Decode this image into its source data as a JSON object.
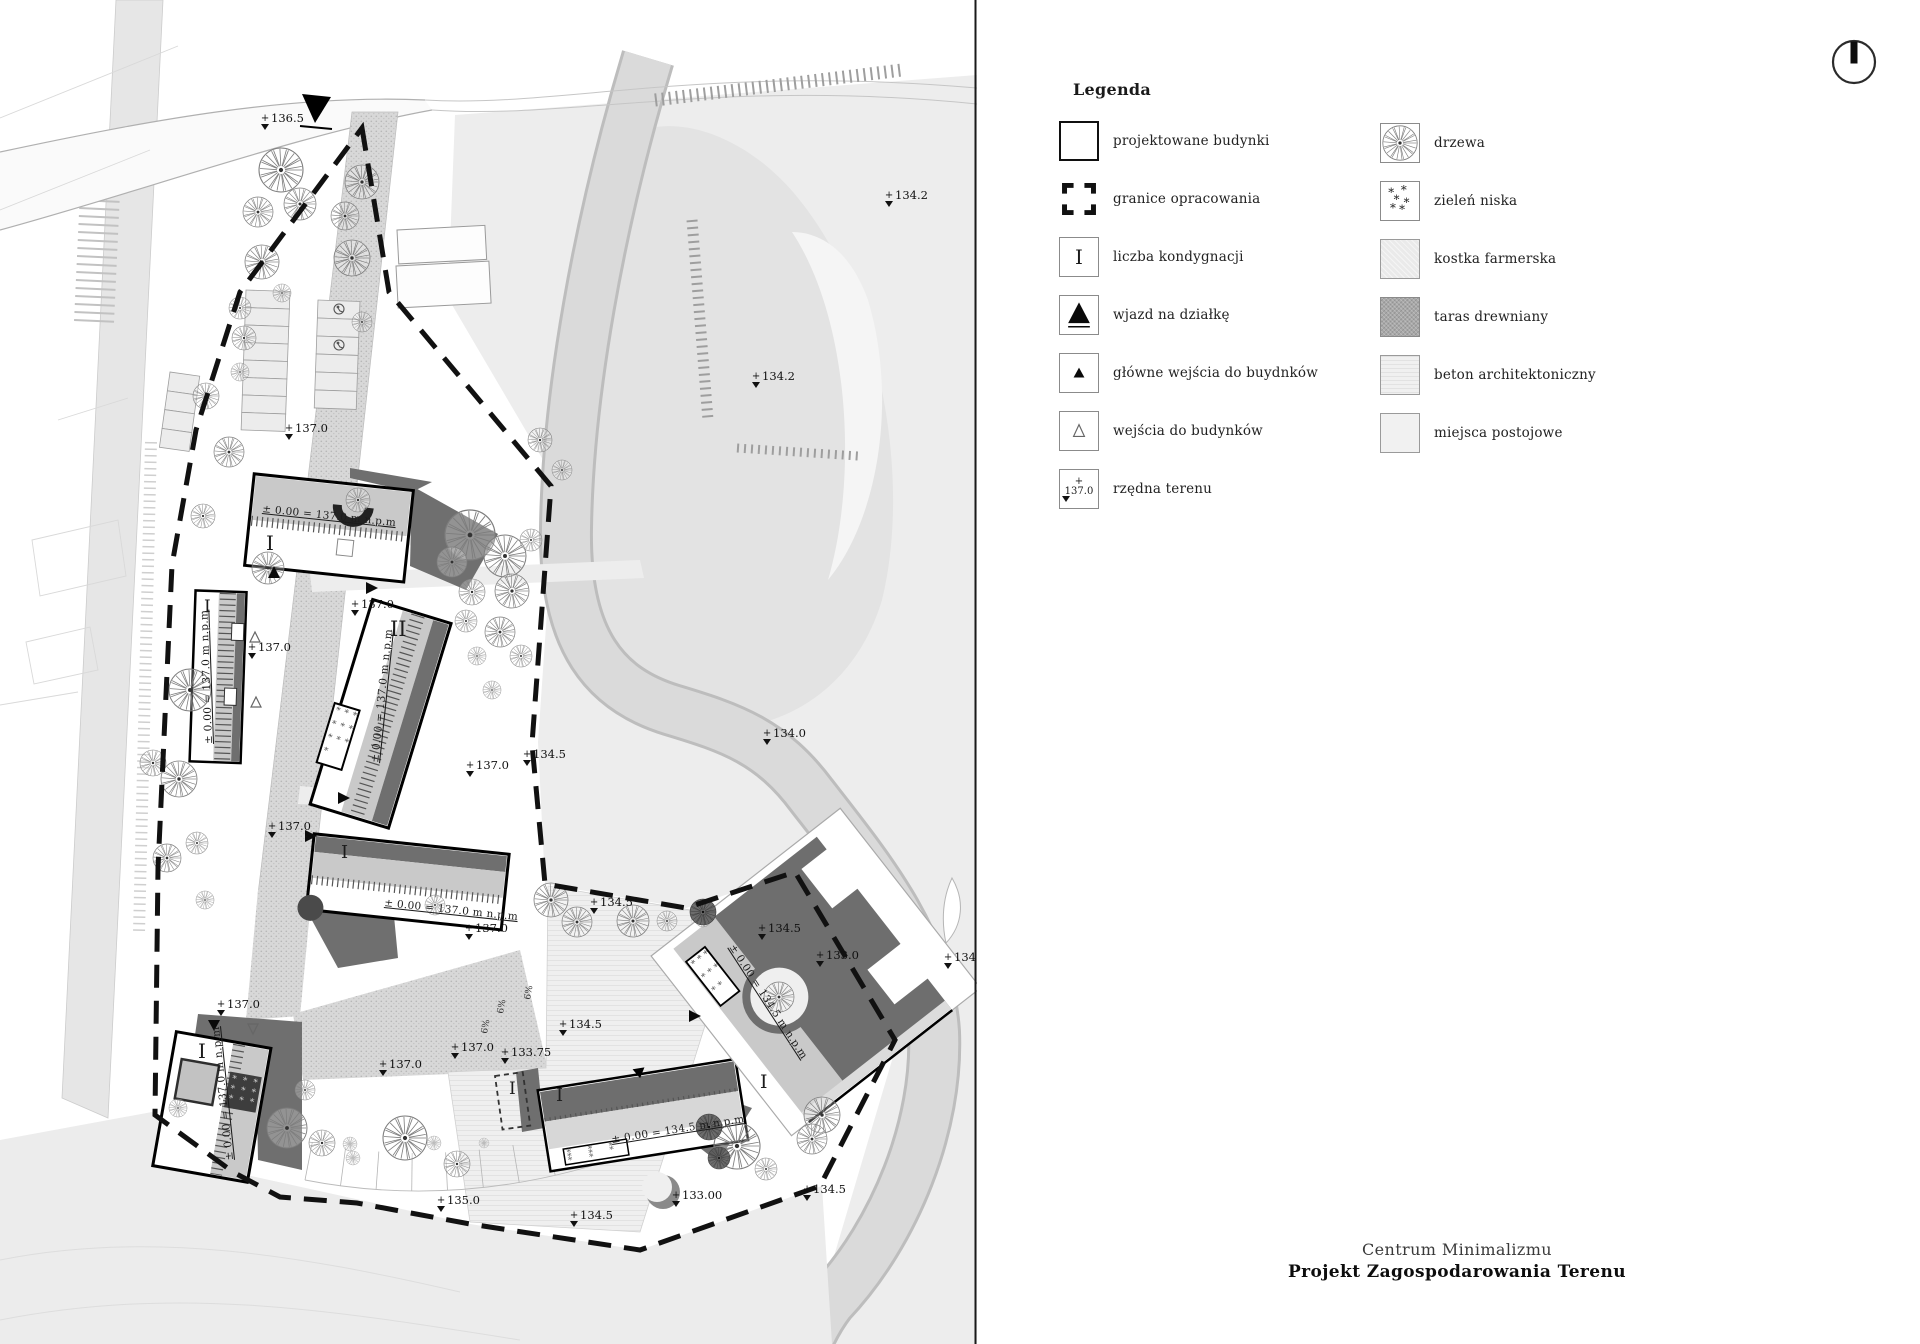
{
  "legend": {
    "title": "Legenda",
    "left_items": [
      {
        "id": "projektowane-budynki",
        "label": "projektowane budynki"
      },
      {
        "id": "granice-opracowania",
        "label": "granice opracowania"
      },
      {
        "id": "liczba-kondygnacji",
        "label": "liczba kondygnacji",
        "symbol_text": "I"
      },
      {
        "id": "wjazd-na-dzialke",
        "label": "wjazd na działkę"
      },
      {
        "id": "glowne-wejscia-do-budynkow",
        "label": "główne wejścia do buydnków"
      },
      {
        "id": "wejscia-do-budynkow",
        "label": "wejścia do budynków"
      },
      {
        "id": "rzedna-terenu",
        "label": "rzędna terenu",
        "symbol_text": "137.0"
      }
    ],
    "right_items": [
      {
        "id": "drzewa",
        "label": "drzewa"
      },
      {
        "id": "zielen-niska",
        "label": "zieleń niska"
      },
      {
        "id": "kostka-farmerska",
        "label": "kostka farmerska"
      },
      {
        "id": "taras-drewniany",
        "label": "taras drewniany"
      },
      {
        "id": "beton-architektoniczny",
        "label": "beton architektoniczny"
      },
      {
        "id": "miejsca-postojowe",
        "label": "miejsca postojowe"
      }
    ]
  },
  "title_block": {
    "line1": "Centrum Minimalizmu",
    "line2": "Projekt Zagospodarowania Terenu"
  },
  "map": {
    "spot_elevations": [
      {
        "x": 265,
        "y": 119,
        "v": "136.5"
      },
      {
        "x": 889,
        "y": 196,
        "v": "134.2"
      },
      {
        "x": 756,
        "y": 377,
        "v": "134.2"
      },
      {
        "x": 289,
        "y": 429,
        "v": "137.0"
      },
      {
        "x": 355,
        "y": 605,
        "v": "137.0"
      },
      {
        "x": 252,
        "y": 648,
        "v": "137.0"
      },
      {
        "x": 470,
        "y": 766,
        "v": "137.0"
      },
      {
        "x": 527,
        "y": 755,
        "v": "134.5"
      },
      {
        "x": 767,
        "y": 734,
        "v": "134.0"
      },
      {
        "x": 272,
        "y": 827,
        "v": "137.0"
      },
      {
        "x": 594,
        "y": 903,
        "v": "134.5"
      },
      {
        "x": 469,
        "y": 929,
        "v": "137.0"
      },
      {
        "x": 563,
        "y": 1025,
        "v": "134.5"
      },
      {
        "x": 455,
        "y": 1048,
        "v": "137.0"
      },
      {
        "x": 383,
        "y": 1065,
        "v": "137.0"
      },
      {
        "x": 505,
        "y": 1053,
        "v": "133.75"
      },
      {
        "x": 948,
        "y": 958,
        "v": "134.0"
      },
      {
        "x": 221,
        "y": 1005,
        "v": "137.0"
      },
      {
        "x": 762,
        "y": 929,
        "v": "134.5"
      },
      {
        "x": 820,
        "y": 956,
        "v": "133.0"
      },
      {
        "x": 441,
        "y": 1201,
        "v": "135.0"
      },
      {
        "x": 676,
        "y": 1196,
        "v": "133.00"
      },
      {
        "x": 574,
        "y": 1216,
        "v": "134.5"
      },
      {
        "x": 807,
        "y": 1190,
        "v": "134.5"
      }
    ],
    "storey_labels": [
      {
        "x": 266,
        "y": 550,
        "v": "I",
        "s": 20
      },
      {
        "x": 204,
        "y": 612,
        "v": "I",
        "s": 17
      },
      {
        "x": 390,
        "y": 636,
        "v": "II",
        "s": 21
      },
      {
        "x": 341,
        "y": 858,
        "v": "I",
        "s": 18
      },
      {
        "x": 198,
        "y": 1058,
        "v": "I",
        "s": 20
      },
      {
        "x": 509,
        "y": 1094,
        "v": "I",
        "s": 17
      },
      {
        "x": 556,
        "y": 1101,
        "v": "I",
        "s": 18
      },
      {
        "x": 760,
        "y": 1088,
        "v": "I",
        "s": 19
      }
    ],
    "level_texts": [
      {
        "x": 262,
        "y": 512,
        "r": 6,
        "v": "± 0.00 = 137.0 m n.p.m"
      },
      {
        "x": 212,
        "y": 744,
        "r": -92,
        "v": "± 0.00 = 137.0 m n.p.m"
      },
      {
        "x": 378,
        "y": 763,
        "r": -84,
        "v": "± 0.00 = 137.0 m n.p.m"
      },
      {
        "x": 384,
        "y": 906,
        "r": 6,
        "v": "± 0.00 = 137.0 m n.p.m"
      },
      {
        "x": 233,
        "y": 1160,
        "r": -96,
        "v": "± 0.00 = 137.0 m n.p.m"
      },
      {
        "x": 612,
        "y": 1143,
        "r": -9,
        "v": "± 0.00 = 134.5 m n.p.m"
      },
      {
        "x": 729,
        "y": 947,
        "r": 57,
        "v": "± 0.00 = 134.5 m n.p.m"
      }
    ],
    "slope_labels": [
      {
        "x": 487,
        "y": 1034,
        "r": -80,
        "v": "6%"
      },
      {
        "x": 503,
        "y": 1014,
        "r": -80,
        "v": "6%"
      },
      {
        "x": 530,
        "y": 1000,
        "r": -80,
        "v": "6%"
      }
    ]
  },
  "colors": {
    "roof_grey": "#c9c9c9",
    "shadow_grey": "#6f6f6f",
    "deck_dark": "#6e6e6e",
    "water": "#e3e3e3",
    "boundary": "#111111"
  }
}
